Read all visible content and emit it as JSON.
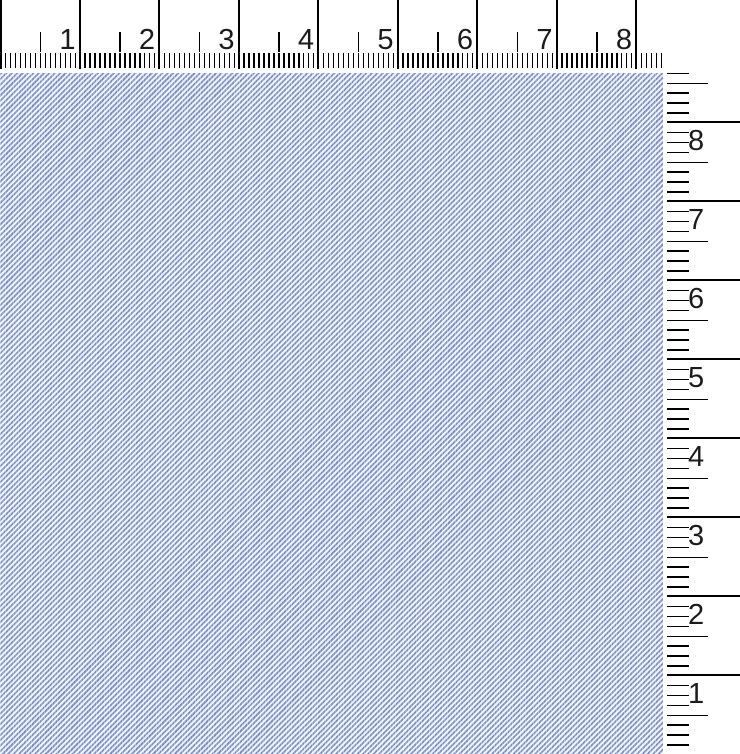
{
  "colors": {
    "background": "#ffffff",
    "tick": "#000000",
    "number": "#1b1b1b",
    "fabric_blue": "#7b8ec7",
    "fabric_white": "#eff1f8"
  },
  "fabric": {
    "description": "periwinkle blue twill fabric swatch with fine diagonal weave"
  },
  "horizontal_ruler": {
    "numbers": [
      "1",
      "2",
      "3",
      "4",
      "5",
      "6",
      "7",
      "8"
    ]
  },
  "vertical_ruler": {
    "numbers": [
      "8",
      "7",
      "6",
      "5",
      "4",
      "3",
      "2",
      "1"
    ]
  }
}
